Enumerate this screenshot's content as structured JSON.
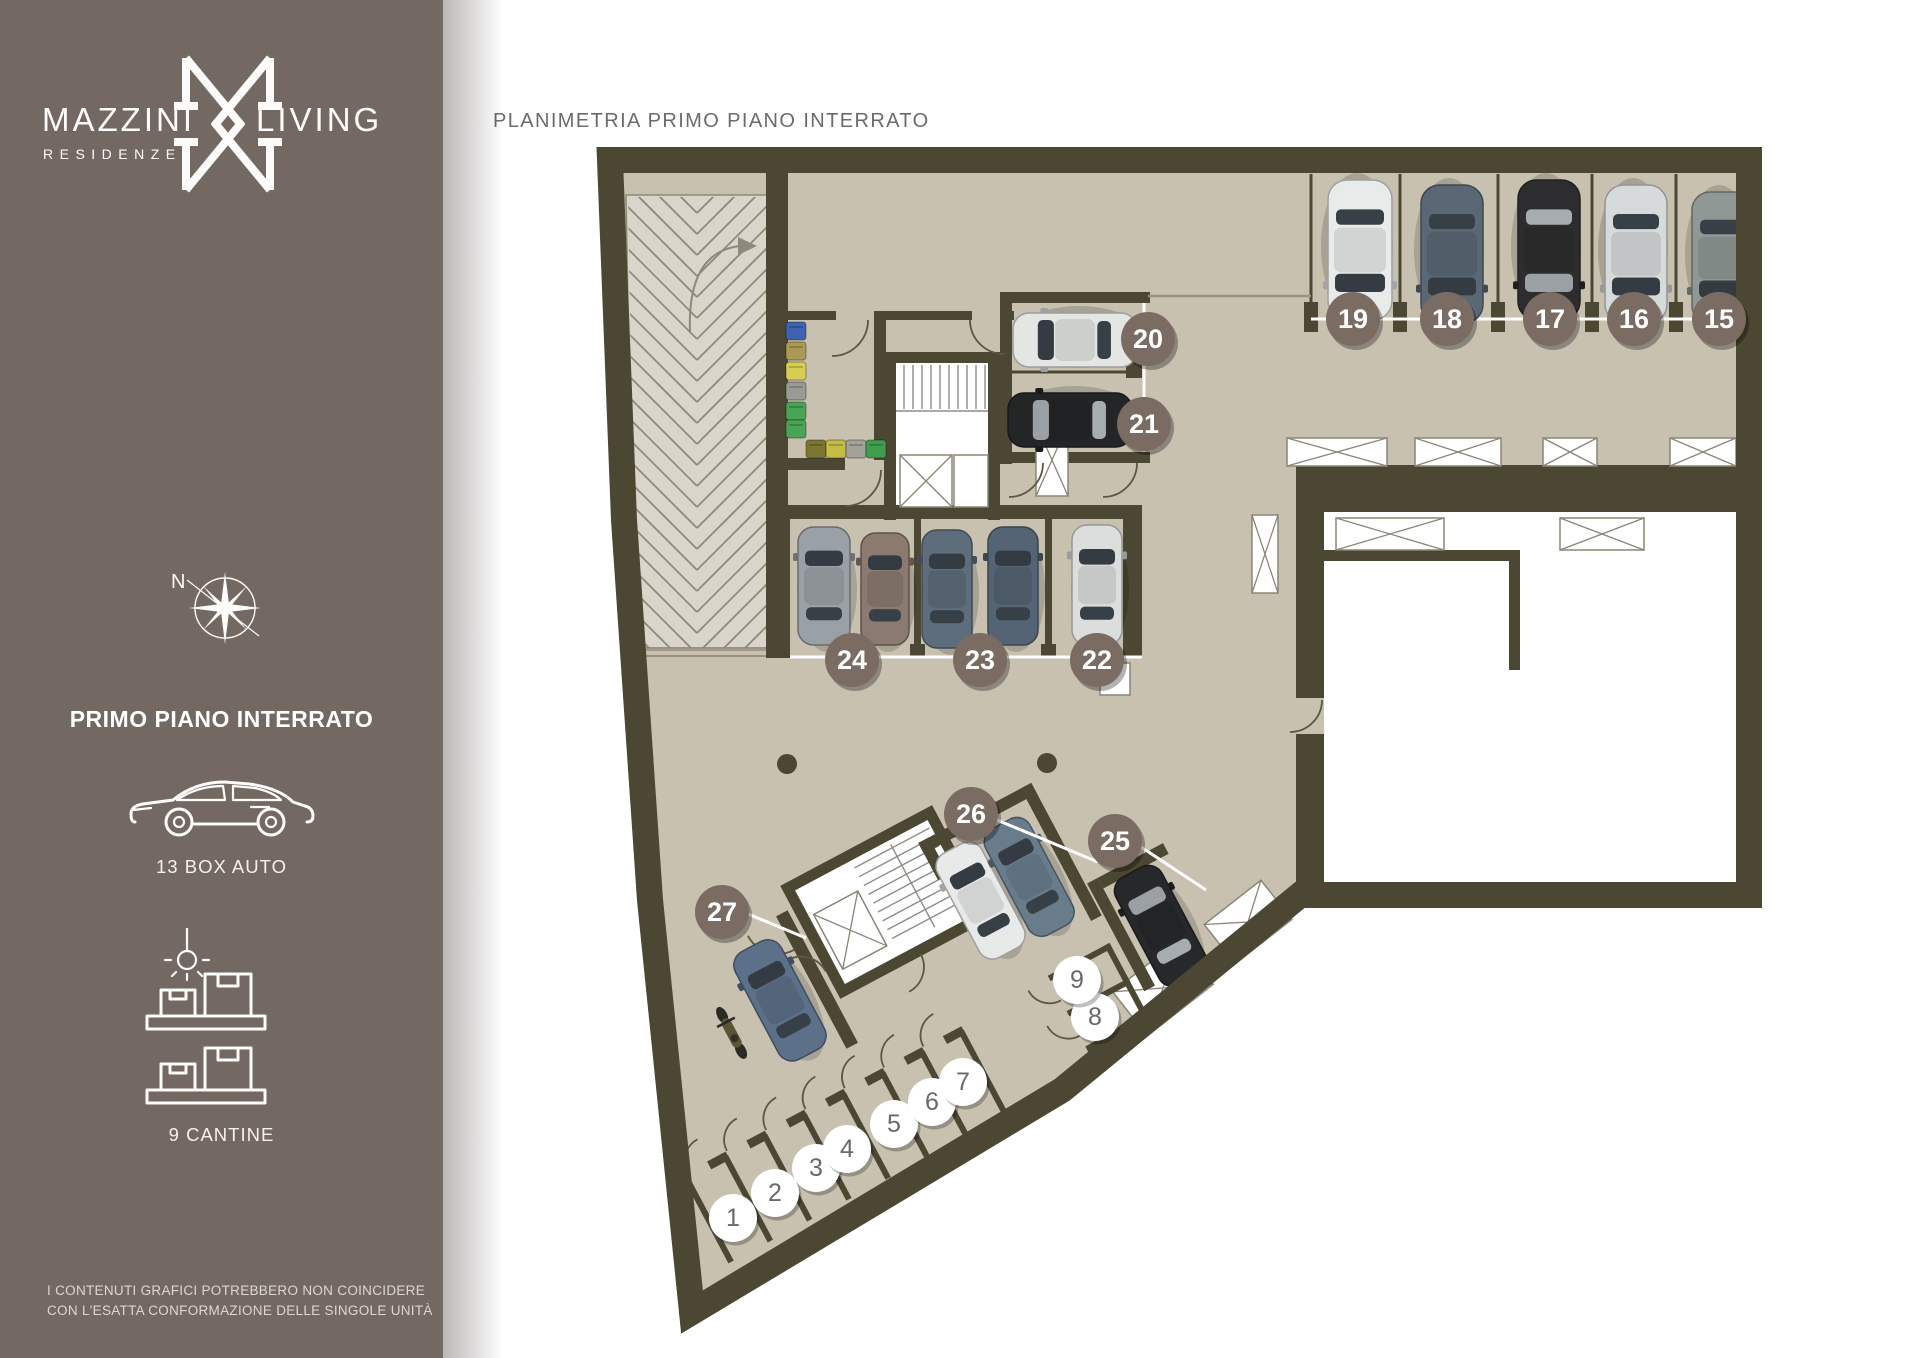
{
  "sidebar": {
    "logo": {
      "word_left": "MAZZINI",
      "word_right": "LIVING",
      "subtitle": "RESIDENZE"
    },
    "compass_label": "N",
    "floor_title": "PRIMO PIANO INTERRATO",
    "stats": [
      {
        "icon": "car-icon",
        "label": "13 BOX AUTO"
      },
      {
        "icon": "cellar-shelf-icon",
        "label": "9 CANTINE"
      }
    ],
    "disclaimer_line1": "I CONTENUTI GRAFICI POTREBBERO NON COINCIDERE",
    "disclaimer_line2": "CON L'ESATTA CONFORMAZIONE DELLE SINGOLE UNITÀ"
  },
  "main": {
    "title": "PLANIMETRIA PRIMO PIANO INTERRATO"
  },
  "plan": {
    "colors": {
      "wall": "#4b4733",
      "floor": "#c8c1b0",
      "ramp": "#d9d5cb",
      "sidebar": "#746962",
      "box_badge": "#7a6b63",
      "box_badge_text": "#ffffff",
      "cantina_badge": "#ffffff",
      "cantina_badge_text": "#6b6866"
    },
    "box_badges": [
      {
        "n": "15",
        "x": 1719,
        "y": 319
      },
      {
        "n": "16",
        "x": 1634,
        "y": 319
      },
      {
        "n": "17",
        "x": 1550,
        "y": 319
      },
      {
        "n": "18",
        "x": 1447,
        "y": 319
      },
      {
        "n": "19",
        "x": 1353,
        "y": 319
      },
      {
        "n": "20",
        "x": 1148,
        "y": 339
      },
      {
        "n": "21",
        "x": 1144,
        "y": 424
      },
      {
        "n": "22",
        "x": 1097,
        "y": 660
      },
      {
        "n": "23",
        "x": 980,
        "y": 660
      },
      {
        "n": "24",
        "x": 852,
        "y": 660
      },
      {
        "n": "25",
        "x": 1115,
        "y": 841
      },
      {
        "n": "26",
        "x": 971,
        "y": 814
      },
      {
        "n": "27",
        "x": 722,
        "y": 912
      }
    ],
    "cantina_badges": [
      {
        "n": "1",
        "x": 733,
        "y": 1218
      },
      {
        "n": "2",
        "x": 775,
        "y": 1193
      },
      {
        "n": "3",
        "x": 816,
        "y": 1168
      },
      {
        "n": "4",
        "x": 847,
        "y": 1149
      },
      {
        "n": "5",
        "x": 894,
        "y": 1124
      },
      {
        "n": "6",
        "x": 932,
        "y": 1102
      },
      {
        "n": "7",
        "x": 963,
        "y": 1082
      },
      {
        "n": "8",
        "x": 1095,
        "y": 1017
      },
      {
        "n": "9",
        "x": 1077,
        "y": 980
      }
    ],
    "cars": [
      {
        "x": 1722,
        "y": 258,
        "angle": 180,
        "len": 132,
        "wid": 60,
        "color": "#8e9894"
      },
      {
        "x": 1636,
        "y": 254,
        "angle": 180,
        "len": 138,
        "wid": 62,
        "color": "#d7dadb"
      },
      {
        "x": 1549,
        "y": 250,
        "angle": 180,
        "len": 140,
        "wid": 62,
        "color": "#2d2d2f"
      },
      {
        "x": 1452,
        "y": 254,
        "angle": 180,
        "len": 138,
        "wid": 62,
        "color": "#5a6876"
      },
      {
        "x": 1360,
        "y": 250,
        "angle": 180,
        "len": 140,
        "wid": 64,
        "color": "#e9ebea"
      },
      {
        "x": 1075,
        "y": 340,
        "angle": -90,
        "len": 124,
        "wid": 54,
        "color": "#e4e6e4"
      },
      {
        "x": 1070,
        "y": 420,
        "angle": -90,
        "len": 124,
        "wid": 54,
        "color": "#232527"
      },
      {
        "x": 1097,
        "y": 585,
        "angle": 0,
        "len": 120,
        "wid": 50,
        "color": "#dcdedd"
      },
      {
        "x": 1013,
        "y": 586,
        "angle": 0,
        "len": 118,
        "wid": 50,
        "color": "#546474"
      },
      {
        "x": 947,
        "y": 589,
        "angle": 0,
        "len": 118,
        "wid": 50,
        "color": "#5d6d7c"
      },
      {
        "x": 885,
        "y": 589,
        "angle": 0,
        "len": 112,
        "wid": 48,
        "color": "#8b7a70"
      },
      {
        "x": 824,
        "y": 586,
        "angle": 0,
        "len": 118,
        "wid": 52,
        "color": "#9aa1a6"
      },
      {
        "x": 734,
        "y": 944,
        "angle": 0,
        "len": 122,
        "wid": 52,
        "color": "#5c7089",
        "wing": true
      },
      {
        "x": 958,
        "y": 950,
        "angle": 0,
        "len": 118,
        "wid": 50,
        "color": "#e8eae9",
        "wing": true
      },
      {
        "x": 1012,
        "y": 952,
        "angle": 0,
        "len": 120,
        "wid": 50,
        "color": "#697c8c",
        "wing": true
      },
      {
        "x": 1105,
        "y": 1057,
        "angle": 0,
        "len": 122,
        "wid": 52,
        "color": "#26282a",
        "wing": true
      }
    ],
    "moto": {
      "x": 676,
      "y": 950,
      "wing": true,
      "color": "#5a5336"
    },
    "bins": {
      "stack": {
        "x": 786,
        "y": 322,
        "step": 20,
        "colors": [
          "#3e63b0",
          "#ab9a55",
          "#d6ce52",
          "#9b9b95",
          "#49a455"
        ]
      },
      "corner": {
        "x": 786,
        "y": 420,
        "color": "#49a455"
      },
      "row": {
        "x": 806,
        "y": 440,
        "step": 20,
        "colors": [
          "#7b7632",
          "#c3bc45",
          "#a2a29b",
          "#3f9e4d"
        ]
      }
    },
    "columns": [
      {
        "x": 787,
        "y": 764
      },
      {
        "x": 1047,
        "y": 763
      }
    ]
  }
}
